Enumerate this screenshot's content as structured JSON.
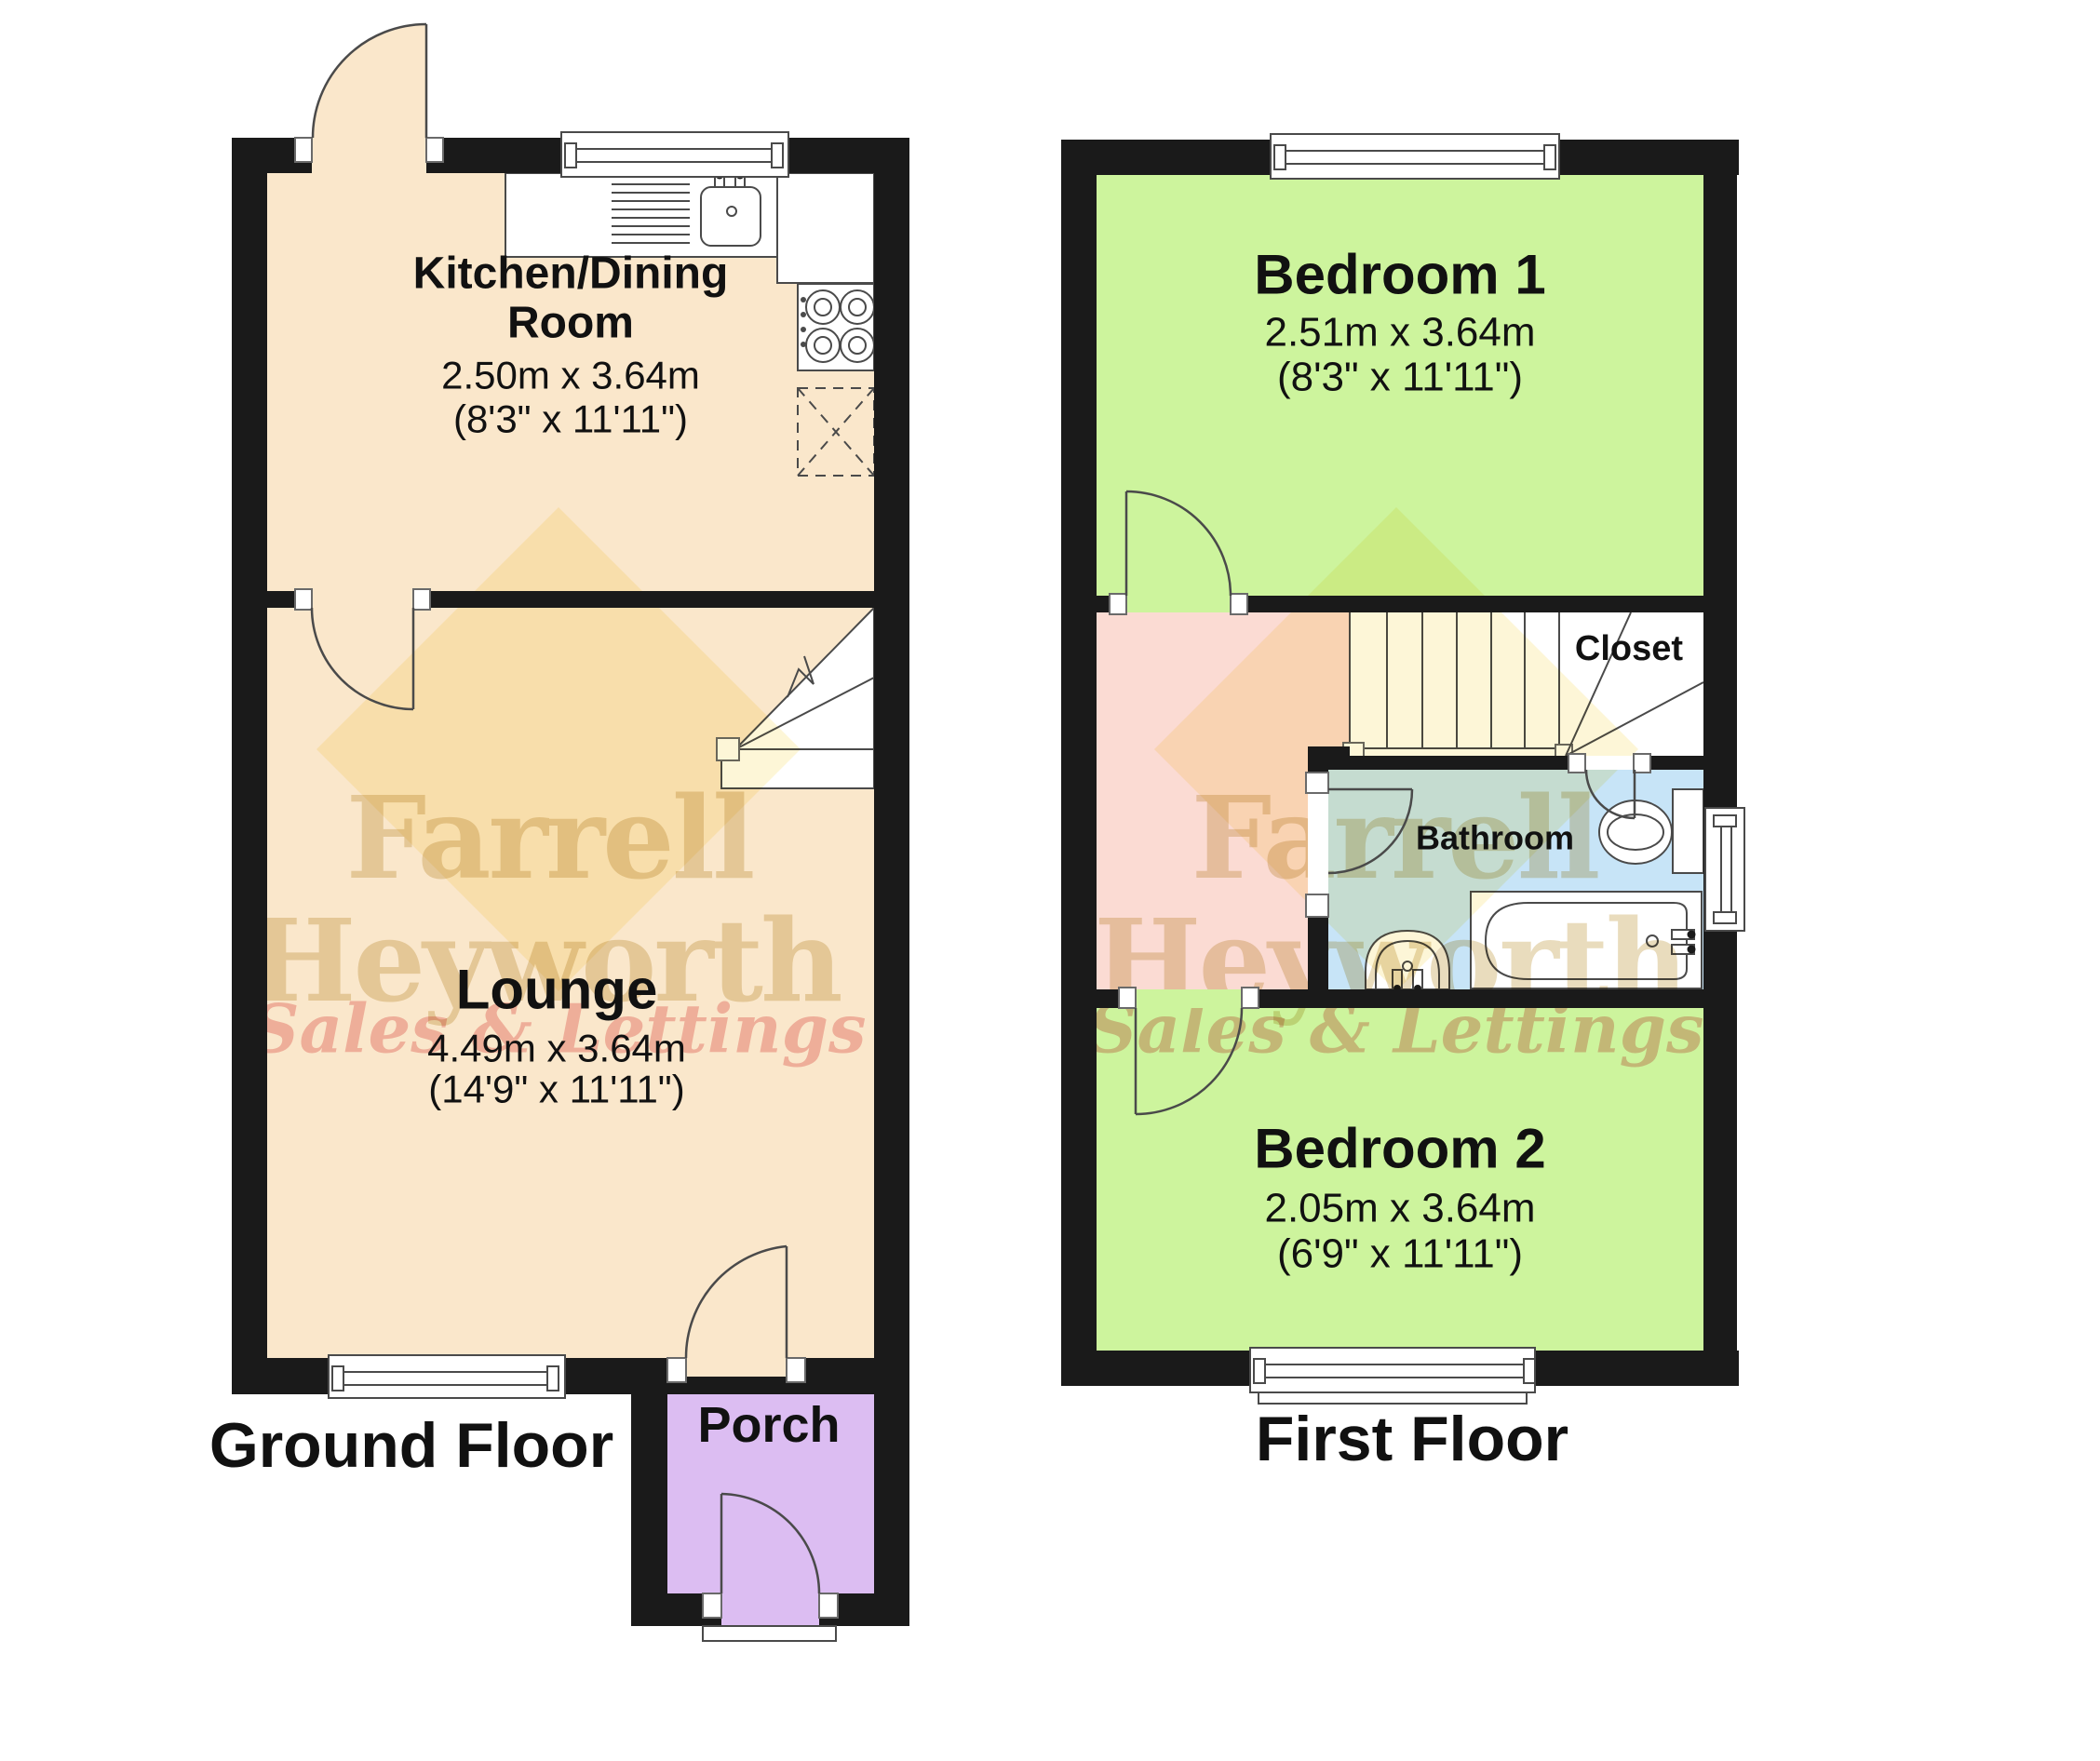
{
  "title": "Floor plan",
  "ground_floor": {
    "floor_label": "Ground Floor",
    "rooms": {
      "kitchen": {
        "name_line1": "Kitchen/Dining",
        "name_line2": "Room",
        "dims_metric": "2.50m x 3.64m",
        "dims_imperial": "(8'3\" x 11'11\")"
      },
      "lounge": {
        "name": "Lounge",
        "dims_metric": "4.49m x 3.64m",
        "dims_imperial": "(14'9\" x 11'11\")"
      },
      "porch": {
        "name": "Porch"
      }
    }
  },
  "first_floor": {
    "floor_label": "First Floor",
    "rooms": {
      "bedroom1": {
        "name": "Bedroom 1",
        "dims_metric": "2.51m x 3.64m",
        "dims_imperial": "(8'3\" x 11'11\")"
      },
      "bedroom2": {
        "name": "Bedroom 2",
        "dims_metric": "2.05m x 3.64m",
        "dims_imperial": "(6'9\" x 11'11\")"
      },
      "bathroom": {
        "name": "Bathroom"
      },
      "closet": {
        "name": "Closet"
      }
    }
  },
  "watermark": {
    "line1": "Farrell",
    "line2": "Heyworth",
    "line3": "Sales & Lettings"
  },
  "colors": {
    "wall": "#1a1a1a",
    "cream_room": "#fae7cb",
    "green_room": "#cdf49d",
    "pink_landing": "#fbdbd3",
    "blue_bathroom": "#c7e4f7",
    "purple_porch": "#dcbdf2",
    "watermark_gold": "#b9912f",
    "watermark_red": "#e05858",
    "watermark_diamond": "#f7dc6f",
    "label_text": "#111111"
  }
}
